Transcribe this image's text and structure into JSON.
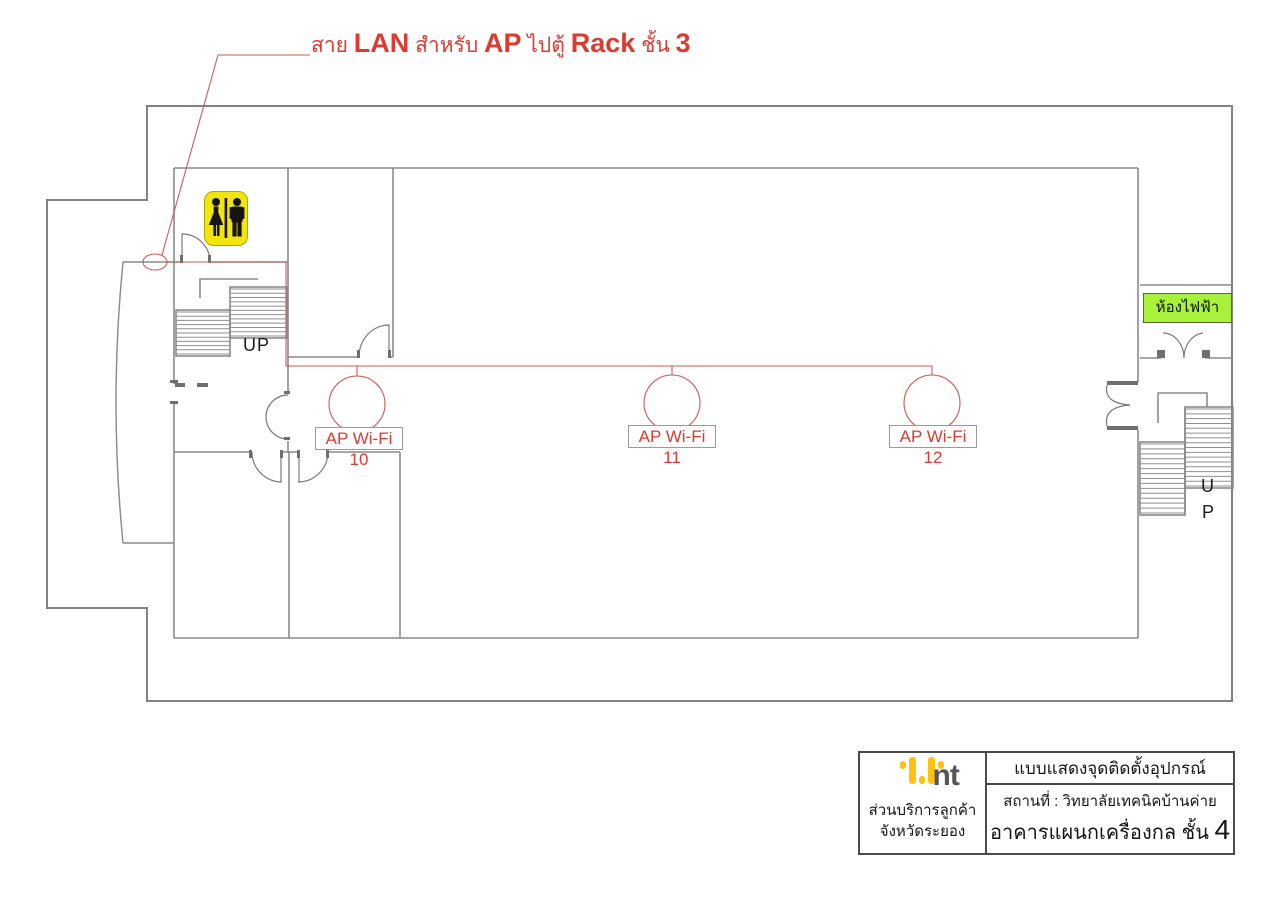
{
  "annotation": {
    "segments": [
      {
        "text": "สาย ",
        "style": "thai"
      },
      {
        "text": "LAN",
        "style": "latin"
      },
      {
        "text": " สำหรับ ",
        "style": "thai"
      },
      {
        "text": "AP",
        "style": "latin"
      },
      {
        "text": " ไปตู้ ",
        "style": "thai"
      },
      {
        "text": "Rack",
        "style": "latin"
      },
      {
        "text": " ชั้น ",
        "style": "thai"
      },
      {
        "text": "3",
        "style": "latin"
      }
    ]
  },
  "plan": {
    "access_points": [
      {
        "label": "AP Wi-Fi 10"
      },
      {
        "label": "AP Wi-Fi 11"
      },
      {
        "label": "AP Wi-Fi 12"
      }
    ],
    "stairs_left_label": "UP",
    "stairs_right_label_top": "U",
    "stairs_right_label_bottom": "P",
    "electrical_room_label": "ห้องไฟฟ้า",
    "restroom_sign_icon": "male-female-restroom-icon"
  },
  "title_block": {
    "brand": "nt",
    "org_line1": "ส่วนบริการลูกค้า",
    "org_line2": "จังหวัดระยอง",
    "doc_title": "แบบแสดงจุดติดตั้งอุปกรณ์",
    "location": "สถานที่ : วิทยาลัยเทคนิคบ้านค่าย",
    "building": "อาคารแผนกเครื่องกล ชั้น ",
    "floor_number": "4"
  },
  "colors": {
    "annotation_red": "#e0392f",
    "cable_red": "#cf5a52",
    "sign_yellow": "#f2e50b",
    "logo_yellow": "#ffc20e",
    "elec_green": "#a9f23b",
    "wall_gray": "#828282"
  }
}
